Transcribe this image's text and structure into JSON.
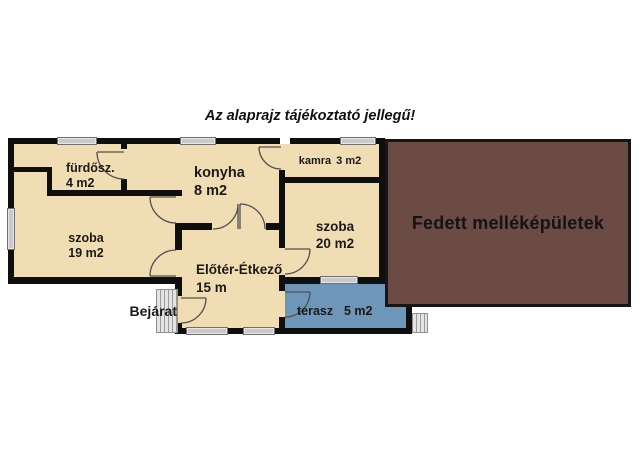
{
  "title": "Az alaprajz tájékoztató jellegű!",
  "entrance_label": "Bejárat",
  "outbuilding_label": "Fedett melléképületek",
  "rooms": {
    "bathroom": {
      "name": "fürdősz.",
      "area": "4 m2"
    },
    "kitchen": {
      "name": "konyha",
      "area": "8 m2"
    },
    "pantry": {
      "name": "kamra",
      "area": "3 m2"
    },
    "room19": {
      "name": "szoba",
      "area": "19 m2"
    },
    "room20": {
      "name": "szoba",
      "area": "20 m2"
    },
    "foyer": {
      "name": "Előtér-Étkező",
      "area": "15 m"
    },
    "terrace": {
      "name": "terasz",
      "area": "5 m2"
    }
  },
  "colors": {
    "background": "#ffffff",
    "room_fill": "#f1ddb3",
    "terrace_fill": "#6d96b8",
    "outbuilding_fill": "#6b4b43",
    "wall": "#0f0f0f",
    "window_fill": "#c9c9c9",
    "window_border": "#6f6f6f",
    "steps_fill": "#e4e4e4",
    "steps_line": "#9b9b9b",
    "door_arc": "#4f4f4f",
    "text": "#1a1a1a"
  }
}
